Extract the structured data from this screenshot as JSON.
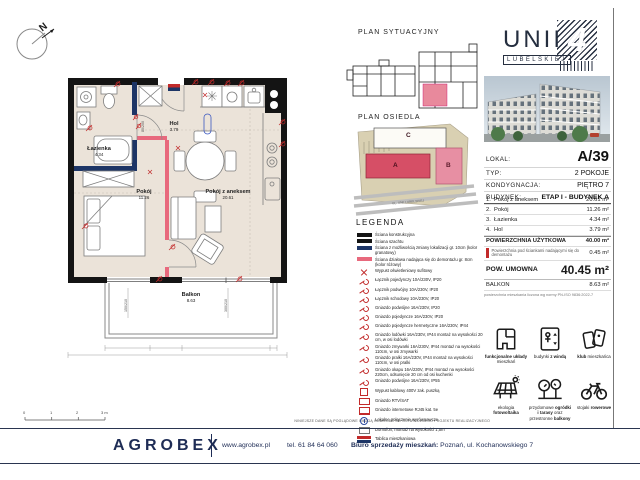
{
  "compass": {
    "letter": "N"
  },
  "floor_plan": {
    "rooms": [
      {
        "name": "Łazienka",
        "area": "4.34"
      },
      {
        "name": "Hol",
        "area": "3.79"
      },
      {
        "name": "Pokój",
        "area": "11.26"
      },
      {
        "name": "Pokój z aneksem",
        "area": "20.61"
      },
      {
        "name": "Balkon",
        "area": "8.63"
      }
    ],
    "dims": {
      "door": "80/200",
      "window_left": "150/210",
      "window_right": "300/210"
    },
    "scale": {
      "t0": "0",
      "t1": "1",
      "t2": "2",
      "t3": "3 m"
    }
  },
  "plans": {
    "situational_title": "PLAN SYTUACYJNY",
    "estate_title": "PLAN OSIEDLA",
    "building_a": "A",
    "building_b": "B",
    "building_c": "C",
    "street": "UL. UNII LUBELSKIEJ"
  },
  "legend": {
    "title": "LEGENDA",
    "items": [
      {
        "text": "Ściana konstrukcyjna"
      },
      {
        "text": "Ściana szachtu"
      },
      {
        "text": "Ściana z możliwością zmiany lokalizacji gr. 10cm (kolor granatowy)"
      },
      {
        "text": "Ściana działowa nadająca się do demontażu gr. 8cm (kolor różowy)"
      },
      {
        "text": "Wypust oświetleniowy sufitowy"
      },
      {
        "text": "Łącznik pojedynczy 10A/230V, IP20"
      },
      {
        "text": "Łącznik podwójny 10A/230V, IP20"
      },
      {
        "text": "Łącznik schodowy 10A/230V, IP20"
      },
      {
        "text": "Gniazdo podwójne 16A/230V, IP20"
      },
      {
        "text": "Gniazdo pojedyncze 16A/230V, IP20"
      },
      {
        "text": "Gniazdo pojedyncze hermetyczne 16A/230V, IP44"
      },
      {
        "text": "Gniazdo lodówki 16A/230V, IP44 montaż na wysokości 20 cm, w osi lodówki"
      },
      {
        "text": "Gniazdo zmywarki 16A/230V, IP44 montaż na wysokości 110cm, w osi zmywarki"
      },
      {
        "text": "Gniazdo pralki 16A/230V, IP44 montaż na wysokości 110cm, w osi pralki"
      },
      {
        "text": "Gniazdo okapu 16A/230V, IP44 montaż na wysokości 220cm, odsunięcie 20 cm od osi kuchenki"
      },
      {
        "text": "Gniazdo podwójne 16A/230V, IP55"
      },
      {
        "text": "Wypust kablowy 400V zak. puszką"
      },
      {
        "text": "Gniazdo RTV/SAT"
      },
      {
        "text": "Gniazdo internetowe RJ45 kat. 5e"
      },
      {
        "text": "Lokalne połączenie wyrównawcze"
      },
      {
        "text": "Domofon, montaż na wysokości 1,5m"
      },
      {
        "text": "Tablica mieszkaniowa"
      }
    ]
  },
  "disclaimer": "NINIEJSZE DANE SĄ POGLĄDOWE I MOGĄ ODBIEGAĆ OD OSTATECZNEGO PROJEKTU REALIZACYJNEGO",
  "brand": {
    "name": "UNII",
    "number": "4",
    "sub": "LUBELSKIEJ"
  },
  "details": {
    "rows": [
      {
        "label": "LOKAL:",
        "value": "A/39"
      },
      {
        "label": "TYP:",
        "value": "2 POKOJE"
      },
      {
        "label": "KONDYGNACJA:",
        "value": "PIĘTRO 7"
      },
      {
        "label": "BUDYNEK:",
        "value": "ETAP I - BUDYNEK A"
      }
    ]
  },
  "area_table": {
    "rows": [
      {
        "no": "1.",
        "name": "Pokój z aneksem",
        "value": "20.61 m²"
      },
      {
        "no": "2.",
        "name": "Pokój",
        "value": "11.26 m²"
      },
      {
        "no": "3.",
        "name": "Łazienka",
        "value": "4.34 m²"
      },
      {
        "no": "4.",
        "name": "Hol",
        "value": "3.79 m²"
      }
    ],
    "usable_label": "POWIERZCHNIA UŻYTKOWA",
    "usable_value": "40.00 m²",
    "note_label": "Powierzchnia pod ściankami nadającymi się do demontażu",
    "note_value": "0.45 m²",
    "contract_label": "POW. UMOWNA",
    "contract_value": "40.45 m²",
    "balcony_label": "BALKON",
    "balcony_value": "8.63 m²",
    "norm_note": "powierzchnia mieszkania liczona wg normy PN-ISO 9836:2022-7"
  },
  "features": [
    {
      "parts": [
        {
          "t": "funkcjonalne układy"
        },
        {
          "t": "mieszkań"
        }
      ]
    },
    {
      "parts": [
        {
          "t": "budynki "
        },
        {
          "t": "z windą"
        }
      ]
    },
    {
      "parts": [
        {
          "t": "klub "
        },
        {
          "t": "mieszkańca"
        }
      ]
    },
    {
      "parts": [
        {
          "t": "ekologia"
        },
        {
          "t": "fotowoltaika"
        }
      ]
    },
    {
      "parts": [
        {
          "t": "przydomowe "
        },
        {
          "t": "ogródki i tarasy "
        },
        {
          "t": "oraz przestronne "
        },
        {
          "t": "balkony"
        }
      ]
    },
    {
      "parts": [
        {
          "t": "stojaki "
        },
        {
          "t": "rowerowe"
        }
      ]
    }
  ],
  "footer": {
    "logo": "AGROBEX",
    "website": "www.agrobex.pl",
    "phone": "tel. 61 84 64 060",
    "office_label": "Biuro sprzedaży mieszkań:",
    "office_value": "Poznań, ul. Kochanowskiego 7"
  }
}
